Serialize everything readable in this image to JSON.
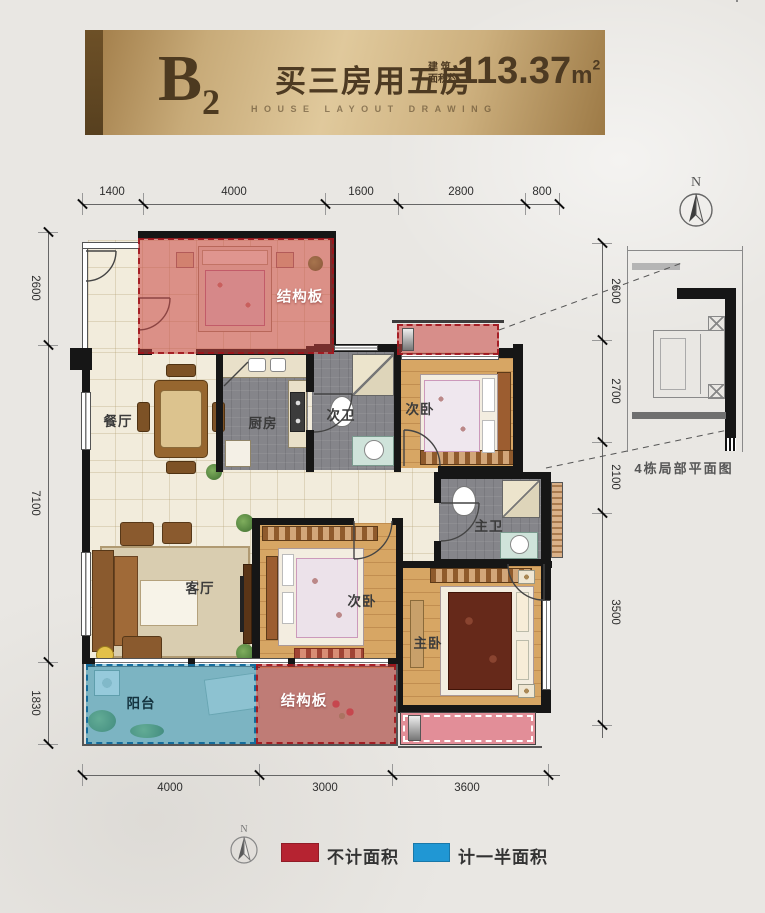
{
  "banner": {
    "unit_main": "B",
    "unit_sub": "2",
    "slogan": "买三房用五房",
    "area_prefix_line1": "建 筑",
    "area_prefix_line2": "面积约",
    "area_value": "113.37",
    "area_unit_base": "m",
    "area_unit_exp": "2",
    "subtitle": "HOUSE LAYOUT DRAWING"
  },
  "compass": {
    "north_label": "N"
  },
  "dimensions": {
    "top": [
      "1400",
      "4000",
      "1600",
      "2800",
      "800"
    ],
    "bottom": [
      "4000",
      "3000",
      "3600"
    ],
    "left": [
      "2600",
      "7100",
      "1830"
    ],
    "right": [
      "2600",
      "2700",
      "2100",
      "3500"
    ]
  },
  "rooms": {
    "slab_top": "结构板",
    "dining": "餐厅",
    "kitchen": "厨房",
    "bath_second": "次卫",
    "bedroom_second_top": "次卧",
    "bath_master": "主卫",
    "living": "客厅",
    "bedroom_second_bottom": "次卧",
    "bedroom_master": "主卧",
    "balcony": "阳台",
    "slab_bottom": "结构板"
  },
  "inset": {
    "caption": "4栋局部平面图"
  },
  "legend": {
    "items": [
      {
        "label": "不计面积",
        "color": "#b62331"
      },
      {
        "label": "计一半面积",
        "color": "#2097d4"
      }
    ]
  },
  "colors": {
    "banner_gold": "#d4b888",
    "banner_text": "#4d3a22",
    "overlay_red": "#c94642",
    "overlay_blue": "#46aacd",
    "wall": "#161616",
    "wood_floor": "#d7a664",
    "tile_floor": "#f2ecdc",
    "gray_floor": "#85858a",
    "legend_red": "#b62331",
    "legend_blue": "#2097d4"
  }
}
